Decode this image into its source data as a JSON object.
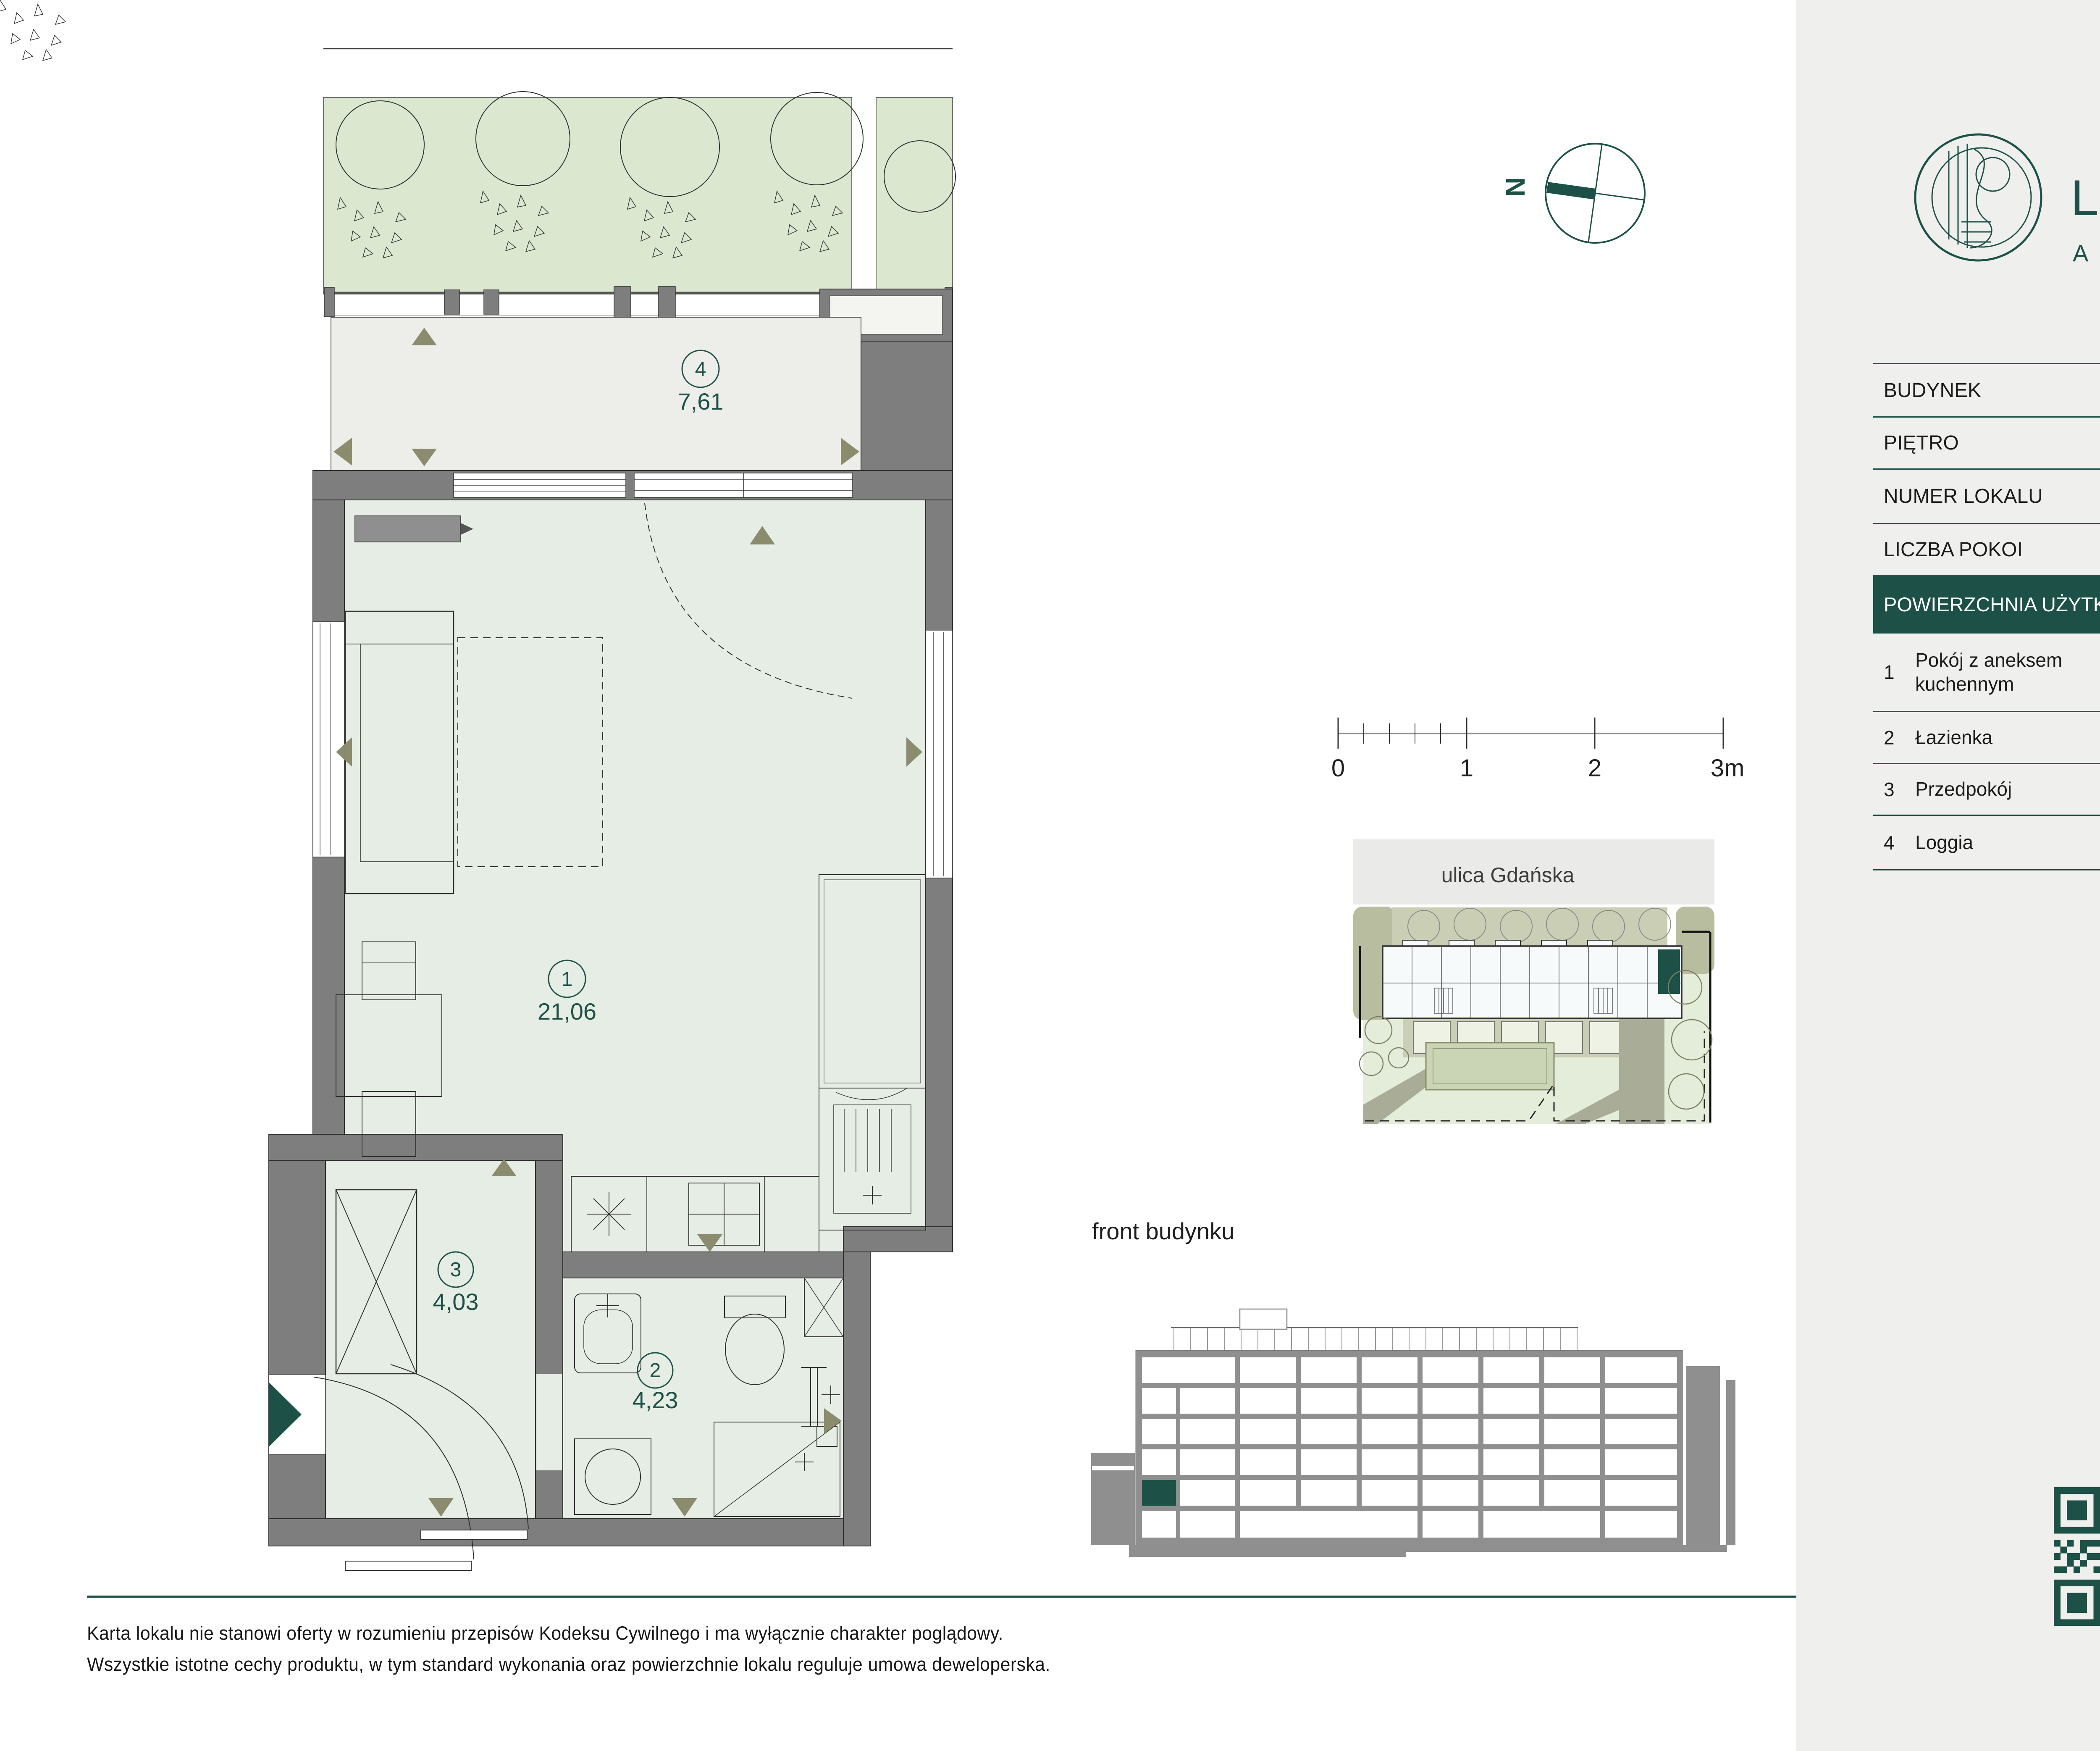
{
  "brand": {
    "name": "LUXSFERA",
    "subtitle": "APARTAMENTY"
  },
  "compass": {
    "north": "N"
  },
  "scale_bar": {
    "ticks": [
      "0",
      "1",
      "2",
      "3m"
    ]
  },
  "site_plan": {
    "street": "ulica Gdańska"
  },
  "elevation": {
    "caption": "front budynku"
  },
  "unit_info": {
    "rows": [
      {
        "label": "BUDYNEK",
        "value": "A"
      },
      {
        "label": "PIĘTRO",
        "value": "1"
      },
      {
        "label": "NUMER LOKALU",
        "value": "A1.1.6"
      },
      {
        "label": "LICZBA POKOI",
        "value": "1P + AK"
      }
    ],
    "area": {
      "label": "POWIERZCHNIA UŻYTKOWA",
      "value": "29,32 m²"
    }
  },
  "rooms": [
    {
      "no": "1",
      "name": "Pokój z aneksem kuchennym",
      "dimensions": "3,93 x 5,65",
      "area": "21,06 m²"
    },
    {
      "no": "2",
      "name": "Łazienka",
      "dimensions": "2,26 x 1,90",
      "area": "4,23 m²"
    },
    {
      "no": "3",
      "name": "Przedpokój",
      "dimensions": "1,52 x 2,65",
      "area": "4,03 m²"
    },
    {
      "no": "4",
      "name": "Loggia",
      "dimensions": "4,43 x 1,66",
      "area": "7,61 m²"
    }
  ],
  "plan_labels": {
    "room1": {
      "no": "1",
      "area": "21,06"
    },
    "room2": {
      "no": "2",
      "area": "4,23"
    },
    "room3": {
      "no": "3",
      "area": "4,03"
    },
    "room4": {
      "no": "4",
      "area": "7,61"
    }
  },
  "footer": {
    "line1": "Karta lokalu nie stanowi oferty w rozumieniu przepisów Kodeksu Cywilnego i ma wyłącznie charakter poglądowy.",
    "line2": "Wszystkie istotne cechy produktu, w tym standard wykonania oraz powierzchnie lokalu reguluje umowa deweloperska."
  },
  "colors": {
    "brand_teal": "#1D5147",
    "wall_gray": "#7E7E7E",
    "room_green": "#E6EDE4",
    "loggia_gray": "#EDEDEA",
    "panel_bg": "#EFEFEE",
    "planting_green": "#DCE7D0",
    "marker_olive": "#8A8C6D",
    "lawn_green": "#E4ECDA",
    "path_olive": "#A9AC96"
  },
  "qr_code": {
    "matrix": [
      "111111100101001111111",
      "100000101101001000001",
      "101110100100101011101",
      "101110101011001011101",
      "101110100110101011101",
      "100000101001001000001",
      "111111101010101111111",
      "000000001101000000000",
      "101011110010110101110",
      "010010011011010010010",
      "101101110100111011010",
      "001010010110100101100",
      "110100101001011010011",
      "000000001011010100100",
      "111111101100101101101",
      "100000101011010010110",
      "101110100101101100101",
      "101110101110010101011",
      "101110100011101011010",
      "100000101101011010110",
      "111111100110100101101"
    ]
  }
}
